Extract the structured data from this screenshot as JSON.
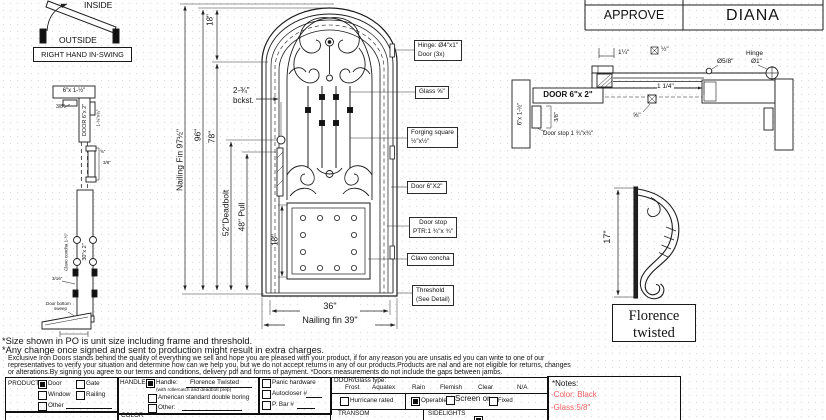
{
  "swing": {
    "inside": "INSIDE",
    "outside": "OUTSIDE",
    "label": "RIGHT HAND IN-SWING"
  },
  "jamb_section": {
    "header_dim": "6\"x 1-½\"",
    "offset": "3/8\"",
    "door_dim": "DOOR 6\"x 2\"",
    "stop_dim": "1-¾\"x¾\"",
    "lock_dim_a": "⅝\"",
    "lock_dim_b": "3/8\"",
    "stile_dim": "30\"x 2\"",
    "clavo": "Clavo concha 1-½\"",
    "gap": "3/16\"",
    "sweep_1": "Door bottom",
    "sweep_2": "sweep"
  },
  "elevation": {
    "dims": {
      "nailing_fin_h": "Nailing Fin 97½\"",
      "frame_h": "96\"",
      "jamb_h": "78\"",
      "arch": "18\"",
      "backset_1": "2-¾\"",
      "backset_2": "bckst.",
      "deadbolt": "52\"Deadbolt",
      "pull": "48\" Pull",
      "panel": "18\"",
      "width": "36\"",
      "nailing_fin_w": "Nailing fin 39\""
    },
    "callouts": {
      "hinge_1": "Hinge: Ø4\"x1\"",
      "hinge_2": "Door (3x)",
      "glass": "Glass ⅝\"",
      "forging_1": "Forging square",
      "forging_2": "½\"x½\"",
      "door": "Door  6\"X2\"",
      "doorstop_1": "Door stop",
      "doorstop_2": "PTR:1 ¾\"x ¾\"",
      "clavo": "Clavo concha",
      "threshold_1": "Threshold",
      "threshold_2": "(See Detail)"
    }
  },
  "approval": {
    "approve": "APPROVE",
    "name": "DIANA"
  },
  "head_section": {
    "jamb_dim": "6\"x 1-½\"",
    "door_label": "DOOR 6\"x 2\"",
    "offset": "3/8\"",
    "doorstop": "Door stop 1 ¾\"x¾\"",
    "dim_top": "1¼\"",
    "glass_square": "½\"",
    "dim_right": "1 1/4\"",
    "glass_thk": "⅝\"",
    "pin": "Ø5/8\"",
    "hinge_1": "Hinge",
    "hinge_2": "Ø1\""
  },
  "handle_detail": {
    "height": "17\"",
    "name_1": "Florence",
    "name_2": "twisted"
  },
  "disclaimer": {
    "line1": "*Size shown in PO is unit size including frame and threshold.",
    "line2": "*Any change once signed and sent to production might result in extra charges.",
    "line3": "Exclusive Iron Doors stands behind the quality of everything we sell and hope you are pleased with your product, if for any reason you are unsatis ed you can write to one of our",
    "line4": "representatives to verify your situation and determine how can we help you, but we do not accept returns in any of our products.Products are  nal and are not eligible for returns, changes",
    "line5": "or alterations.By signing you agree to our terms and conditions, delivery pdf and forms of payment. *Doors measurements do not include the gaps between jambs."
  },
  "form": {
    "product": {
      "label": "PRODUCT:",
      "door": "Door",
      "gate": "Gate",
      "window": "Window",
      "railing": "Railing",
      "other": "Other"
    },
    "handle": {
      "label": "HANDLE",
      "main": "Handle:",
      "value": "Florence Twisted",
      "sub": "(with rollercatch and deadbolt prep)",
      "opt2": "American standard double boring",
      "opt3": "Other:"
    },
    "hardware": {
      "panic": "Panic hardware",
      "autocloser": "Autocloser #",
      "pbar": "P. Bar #"
    },
    "glass": {
      "label": "DOOR/Glass type:",
      "types": [
        "Frost",
        "Aquatex",
        "Rain",
        "Flemish",
        "Clear",
        "N/A"
      ],
      "hurricane": "Hurricane rated",
      "operable": "Operable",
      "screen": "Screen or",
      "fixed": "Fixed"
    },
    "transom": "TRANSOM",
    "sidelights": "SIDELIGHTS",
    "color": "COLOR"
  },
  "notes": {
    "title": "*Notes:",
    "color_line": "-Color: Black",
    "glass_line": "-Glass:5/8\"",
    "accent_red": "#f05f5f"
  }
}
